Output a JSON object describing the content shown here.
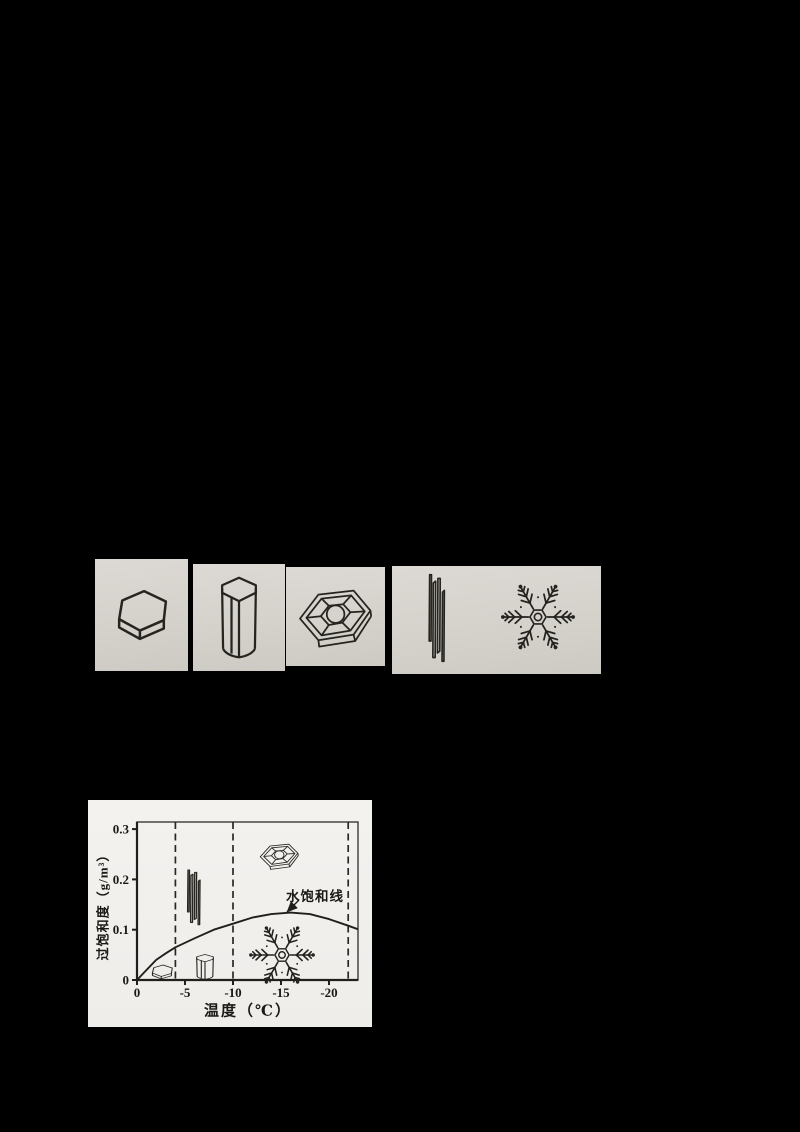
{
  "figures": {
    "crystal_strip": {
      "panels": [
        {
          "name": "hexagonal-plate-crystal"
        },
        {
          "name": "hexagonal-column-crystal"
        },
        {
          "name": "sector-plate-crystal"
        },
        {
          "name": "needle-crystals-and-dendrite"
        }
      ]
    }
  },
  "chart_data": {
    "type": "line",
    "title": "",
    "xlabel": "温度（℃）",
    "ylabel": "过饱和度（g/m³）",
    "xlim": [
      0,
      -23
    ],
    "ylim": [
      0,
      0.314
    ],
    "x_ticks": [
      0,
      -5,
      -10,
      -15,
      -20
    ],
    "x_tick_labels": [
      "0",
      "-5",
      "-10",
      "-15",
      "-20"
    ],
    "y_ticks": [
      0,
      0.1,
      0.2,
      0.3
    ],
    "y_tick_labels": [
      "0",
      "0.1",
      "0.2",
      "0.3"
    ],
    "grid": "off",
    "legend": "none",
    "boundary_lines_x": [
      -4,
      -10,
      -22
    ],
    "series": [
      {
        "name": "水饱和线",
        "x": [
          0,
          -1,
          -2,
          -3,
          -4,
          -6,
          -8,
          -10,
          -12,
          -14,
          -16,
          -18,
          -20,
          -22,
          -23
        ],
        "y": [
          0,
          0.02,
          0.04,
          0.053,
          0.065,
          0.083,
          0.1,
          0.112,
          0.124,
          0.131,
          0.134,
          0.131,
          0.121,
          0.108,
          0.101
        ]
      }
    ],
    "region_icons": [
      {
        "icon": "plate-crystal",
        "temp_c": -2.5,
        "supersaturation_gm3": 0.015
      },
      {
        "icon": "needle-crystals",
        "temp_c": -6,
        "supersaturation_gm3": 0.17
      },
      {
        "icon": "column-crystal",
        "temp_c": -7,
        "supersaturation_gm3": 0.03
      },
      {
        "icon": "sector-plate-crystal",
        "temp_c": -14.5,
        "supersaturation_gm3": 0.25
      },
      {
        "icon": "dendrite-crystal",
        "temp_c": -15,
        "supersaturation_gm3": 0.05
      }
    ]
  }
}
